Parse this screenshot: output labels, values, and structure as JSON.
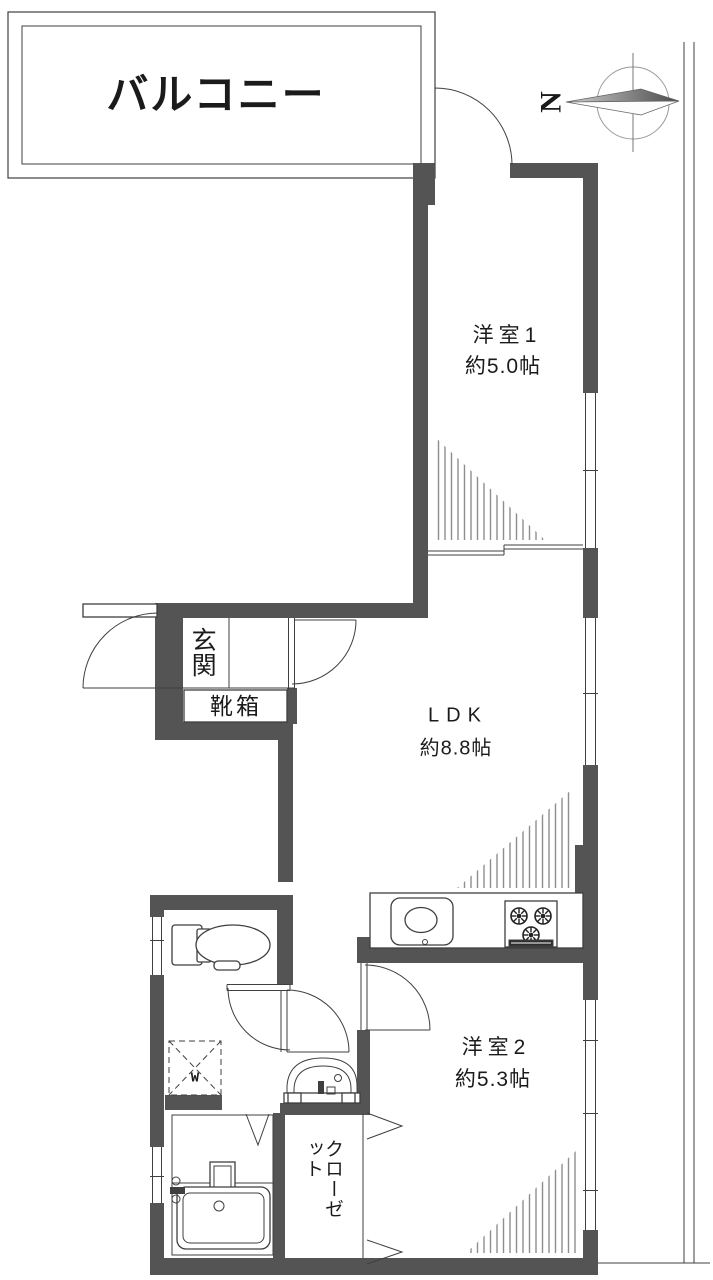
{
  "labels": {
    "balcony": "バルコニー",
    "room1_name": "洋室1",
    "room1_size": "約5.0帖",
    "ldk_name": "LDK",
    "ldk_size": "約8.8帖",
    "room2_name": "洋室2",
    "room2_size": "約5.3帖",
    "entrance": "玄関",
    "shoe_box": "靴箱",
    "closet": "クローゼット",
    "washer": "W",
    "compass_north": "N"
  },
  "colors": {
    "wall": "#545454",
    "line": "#3f3f3f",
    "hatch": "#8e8e8e",
    "text": "#1b1b1b",
    "background": "#ffffff"
  }
}
